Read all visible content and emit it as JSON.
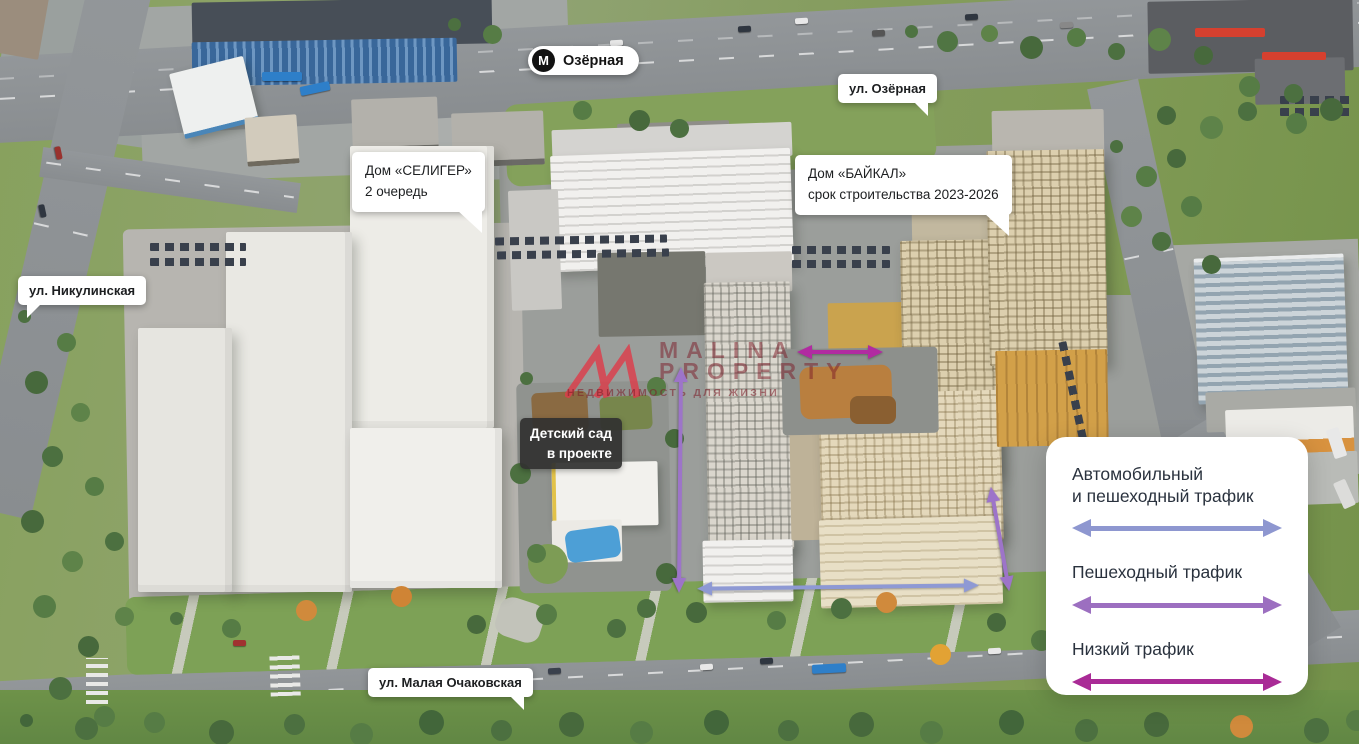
{
  "metro_badge": {
    "logo": "М",
    "label": "Озёрная"
  },
  "street_labels": {
    "ozernaya": "ул. Озёрная",
    "nikulinskaya": "ул. Никулинская",
    "malaya_ochakovskaya": "ул. Малая Очаковская"
  },
  "building_labels": {
    "seliger": {
      "line1": "Дом «СЕЛИГЕР»",
      "line2": "2 очередь"
    },
    "baikal": {
      "line1": "Дом «БАЙКАЛ»",
      "line2": "срок строительства 2023-2026"
    }
  },
  "site_labels": {
    "kindergarten": {
      "line1": "Детский сад",
      "line2": "в проекте"
    }
  },
  "watermark": {
    "brand_line1": "MALINA",
    "brand_line2": "PROPERTY",
    "tagline": "НЕДВИЖИМОСТЬ ДЛЯ ЖИЗНИ",
    "logo_color": "#df3b49",
    "text_color": "#7d1c28"
  },
  "legend": {
    "items": [
      {
        "id": "car-and-pedestrian",
        "lines": [
          "Автомобильный",
          "и пешеходный трафик"
        ],
        "color": "#8e97d0"
      },
      {
        "id": "pedestrian",
        "lines": [
          "Пешеходный трафик"
        ],
        "color": "#9c6fc0"
      },
      {
        "id": "low-traffic",
        "lines": [
          "Низкий трафик"
        ],
        "color": "#a92b96"
      }
    ]
  },
  "map_arrows": {
    "courtyard_low_traffic": {
      "color": "#b12ba1"
    },
    "pedestrian_west": {
      "color": "#9d74c9"
    },
    "pedestrian_east": {
      "color": "#9d74c9"
    },
    "street_car_pedestrian": {
      "color": "#8e99d4"
    }
  }
}
